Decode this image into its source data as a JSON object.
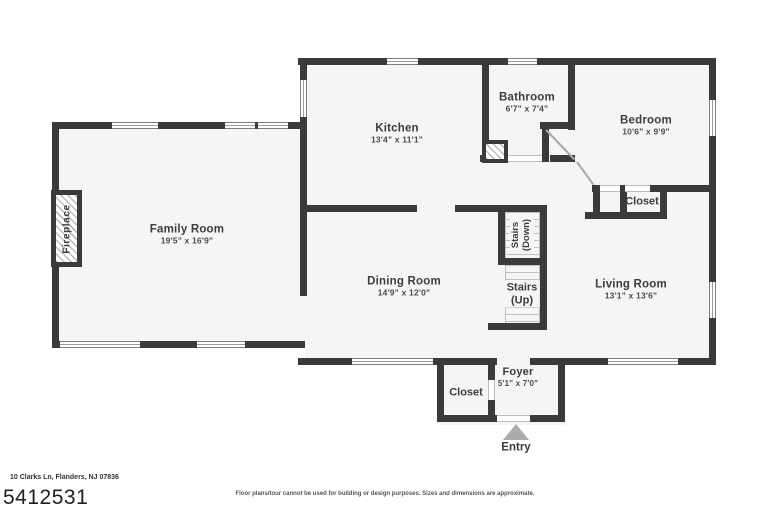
{
  "floorplan": {
    "rooms": {
      "kitchen": {
        "name": "Kitchen",
        "dims": "13'4\" x 11'1\""
      },
      "bathroom": {
        "name": "Bathroom",
        "dims": "6'7\" x 7'4\""
      },
      "bedroom": {
        "name": "Bedroom",
        "dims": "10'6\" x 9'9\""
      },
      "family_room": {
        "name": "Family Room",
        "dims": "19'5\" x 16'9\""
      },
      "dining_room": {
        "name": "Dining Room",
        "dims": "14'9\" x 12'0\""
      },
      "living_room": {
        "name": "Living Room",
        "dims": "13'1\" x 13'6\""
      },
      "foyer": {
        "name": "Foyer",
        "dims": "5'1\" x 7'0\""
      },
      "bedroom_closet": {
        "name": "Closet"
      },
      "foyer_closet": {
        "name": "Closet"
      },
      "stairs_down": {
        "line1": "Stairs",
        "line2": "(Down)"
      },
      "stairs_up": {
        "line1": "Stairs",
        "line2": "(Up)"
      },
      "fireplace": {
        "name": "Fireplace"
      },
      "entry": {
        "name": "Entry"
      }
    },
    "footer": {
      "address": "10 Clarks Ln, Flanders, NJ 07836",
      "mls_number": "5412531",
      "disclaimer": "Floor plans/tour cannot be used for building or design purposes. Sizes and dimensions are approximate."
    },
    "colors": {
      "wall": "#3a3a3a",
      "floor": "#f5f5f5",
      "text": "#3d3d3d"
    }
  }
}
